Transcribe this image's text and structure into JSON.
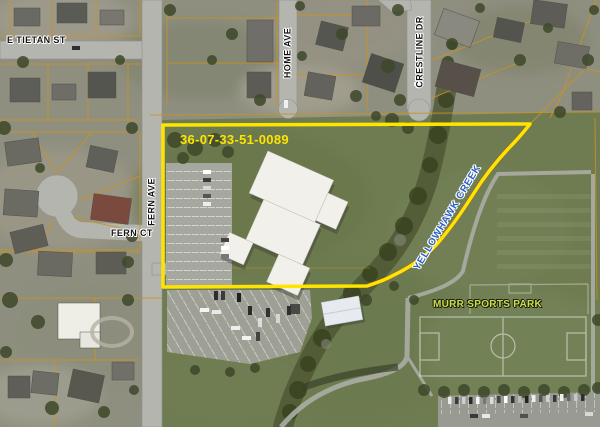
{
  "map": {
    "parcel_id": "36-07-33-51-0089",
    "streets": {
      "e_tietan": "E TIETAN ST",
      "home_ave": "HOME AVE",
      "crestline_dr": "CRESTLINE DR",
      "fern_ave": "FERN AVE",
      "fern_ct": "FERN CT"
    },
    "creek_label": "YELLOWHAWK CREEK",
    "park_label": "MURR SPORTS PARK",
    "colors": {
      "parcel_boundary": "#FFE400",
      "parcel_id_text": "#FFE400",
      "creek_text": "#2A5FC6",
      "park_text": "#CBDE4F",
      "street_text": "#141414",
      "lot_lines": "#C9931F",
      "road": "#B3B5AE"
    }
  }
}
